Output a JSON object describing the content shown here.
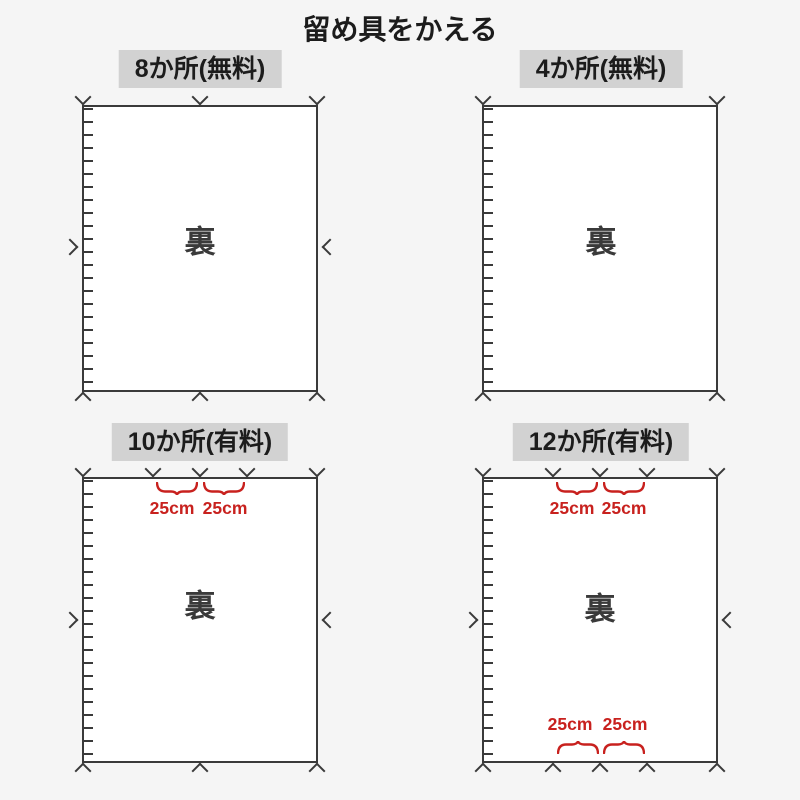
{
  "page": {
    "title": "留め具をかえる"
  },
  "colors": {
    "background": "#f5f5f5",
    "header_bg": "#d2d2d2",
    "line": "#3a3a3a",
    "measure_red": "#c8211e"
  },
  "panels": [
    {
      "id": "8-places-free",
      "title": "8か所(無料)",
      "back_label": "裏",
      "fastener_marks": {
        "top": 3,
        "bottom": 3,
        "left": 1,
        "right": 1,
        "total": 8
      }
    },
    {
      "id": "4-places-free",
      "title": "4か所(無料)",
      "back_label": "裏",
      "fastener_marks": {
        "top": 2,
        "bottom": 2,
        "left": 0,
        "right": 0,
        "total": 4
      }
    },
    {
      "id": "10-places-paid",
      "title": "10か所(有料)",
      "back_label": "裏",
      "fastener_marks": {
        "top": 5,
        "bottom": 3,
        "left": 1,
        "right": 1,
        "total": 10
      },
      "top_measurements": [
        "25cm",
        "25cm"
      ]
    },
    {
      "id": "12-places-paid",
      "title": "12か所(有料)",
      "back_label": "裏",
      "fastener_marks": {
        "top": 5,
        "bottom": 5,
        "left": 1,
        "right": 1,
        "total": 12
      },
      "top_measurements": [
        "25cm",
        "25cm"
      ],
      "bottom_measurements": [
        "25cm",
        "25cm"
      ]
    }
  ]
}
